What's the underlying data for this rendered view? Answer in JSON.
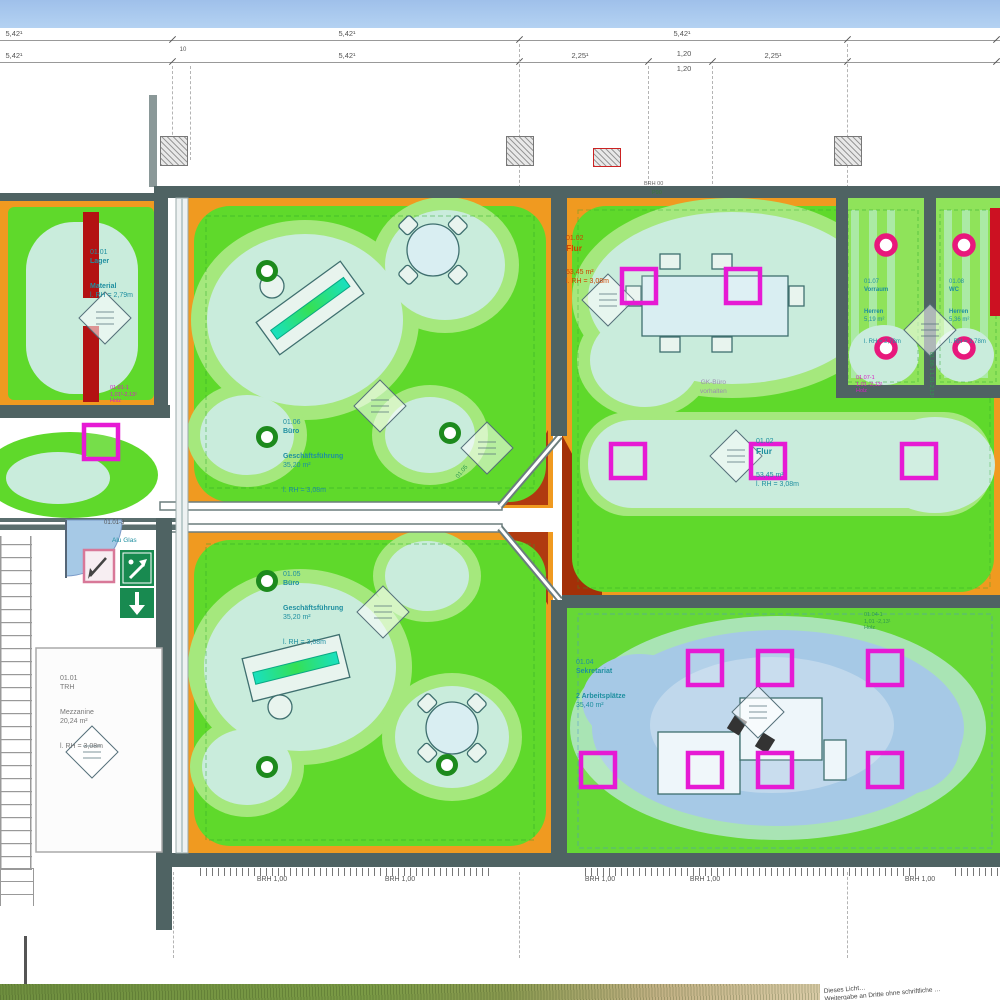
{
  "colors": {
    "sky": "#a8c6ee",
    "orange": "#f09a20",
    "green": "#5fd92b",
    "pale_green": "#a5e87d",
    "cyan": "#c9ecdc",
    "blue": "#a6c9e6",
    "red_bar": "#b31212",
    "wedge": "#a33008",
    "magenta": "#e61ad4",
    "pink_donut": "#e8187c",
    "green_donut": "#1d8a1d",
    "wall": "#4f6363",
    "label_teal": "#1f8fa0",
    "label_red": "#cc4400",
    "tag_magenta": "#d81ec4",
    "tag_green": "#2f9a4f"
  },
  "dims": {
    "r1": [
      "5,42¹",
      "5,42¹",
      "5,42¹"
    ],
    "r2": [
      "5,42¹",
      "10",
      "5,42¹",
      "2,25¹",
      "1,20",
      "2,25¹"
    ],
    "r2b": "1,20"
  },
  "rooms": {
    "lager": {
      "code": "01.01",
      "name": "Lager",
      "name2": "Material",
      "height": "l. RH = 2,79m"
    },
    "buero1": {
      "code": "01.06",
      "name": "Büro",
      "name2": "Geschäftsführung",
      "area": "35,20 m²",
      "height": "l. RH = 3,08m"
    },
    "buero2": {
      "code": "01.05",
      "name": "Büro",
      "name2": "Geschäftsführung",
      "area": "35,20 m²",
      "height": "l. RH = 3,08m"
    },
    "flur_top": {
      "code": "01.02",
      "name": "Flur",
      "area": "53,45 m²",
      "height": "l. RH = 3,08m"
    },
    "flur_mid": {
      "code": "01.02",
      "name": "Flur",
      "area": "53,45 m²",
      "height": "l. RH = 3,08m"
    },
    "vorraum": {
      "code": "01.07",
      "name": "Vorraum",
      "name2": "Herren",
      "area": "5,19 m²",
      "height": "l. RH = 2,78m"
    },
    "wc": {
      "code": "01.08",
      "name": "WC",
      "name2": "Herren",
      "area": "5,36 m²",
      "height": "l. RH = 2,78m"
    },
    "trh": {
      "code": "01.01",
      "name": "TRH",
      "name2": "Mezzanine",
      "area": "20,24 m²",
      "height": "l. RH = 3,08m"
    },
    "sek": {
      "code": "01.04",
      "name": "Sekretariat",
      "name2": "2 Arbeitsplätze",
      "area": "35,40 m²"
    }
  },
  "tags": {
    "t1": {
      "l1": "01.01-1",
      "l2": "1,01¹-2,13¹",
      "l3": "Holz"
    },
    "t2": {
      "l1": "01.07-1",
      "l2": "1,01 -2,13¹",
      "l3": "Holz"
    },
    "t3": {
      "l1": "01.04-1",
      "l2": "1,01 -2,13¹",
      "l3": "Holz"
    },
    "t4": "01.08-1 1,01-2,13¹",
    "wall_tag": "01.01-3",
    "alu": "Alu Glas",
    "junction": "01.05"
  },
  "notes": {
    "gk1": "GK-Büro",
    "gk2": "vorhalten",
    "brh00": "BRH 00",
    "p90": "P90"
  },
  "windows": {
    "brh": "BRH 1,00"
  },
  "watermark": {
    "l1": "Dieses Licht…",
    "l2": "Weitergabe an Dritte ohne schriftliche …"
  }
}
